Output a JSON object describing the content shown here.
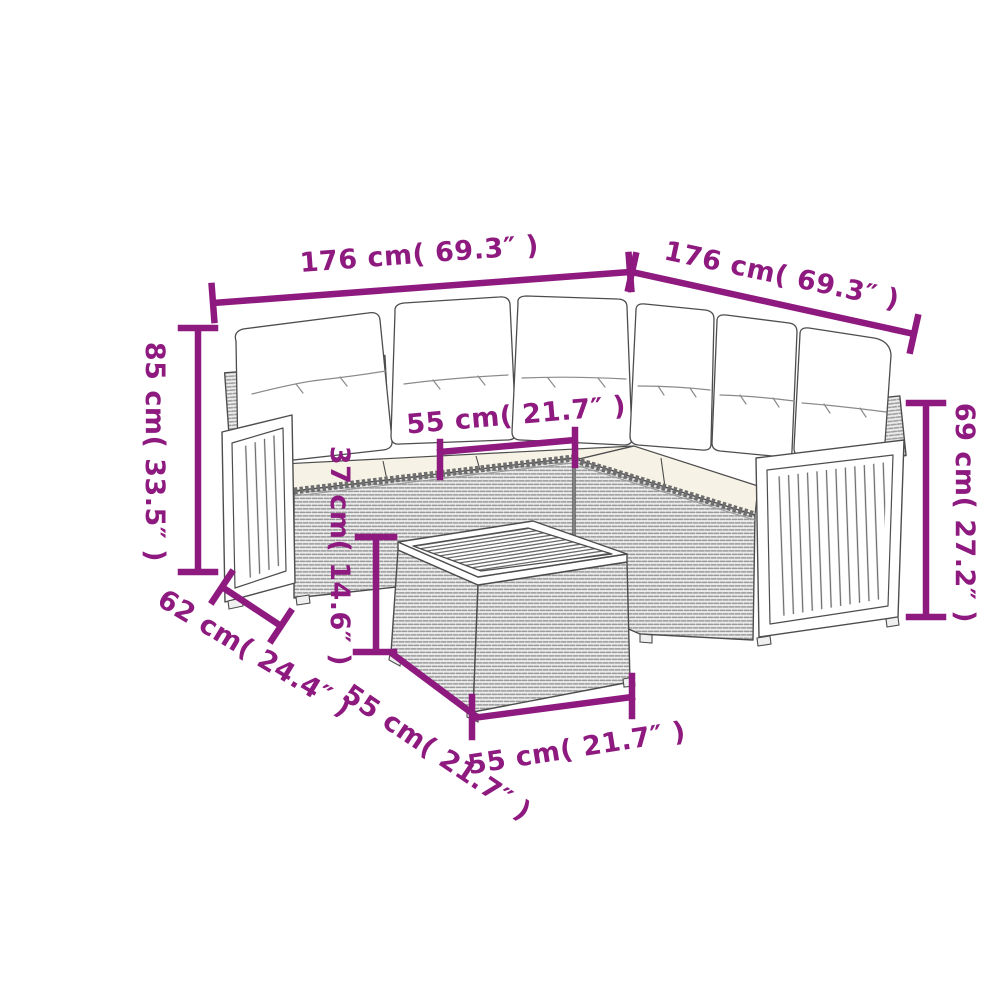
{
  "figure": {
    "type": "product-dimension-diagram",
    "subject": "corner rattan lounge set with slatted wood armrests, cushions and square side table",
    "background_color": "#ffffff",
    "accent_color": "#8e1a80",
    "line_art_color": "#4d4d4d"
  },
  "dimensions": {
    "sofa_left_width": {
      "label": "176 cm( 69.3″ )",
      "cm": 176,
      "inches": 69.3
    },
    "sofa_right_width": {
      "label": "176 cm( 69.3″ )",
      "cm": 176,
      "inches": 69.3
    },
    "sofa_height": {
      "label": "85 cm( 33.5″ )",
      "cm": 85,
      "inches": 33.5
    },
    "seat_width": {
      "label": "55 cm( 21.7″ )",
      "cm": 55,
      "inches": 21.7
    },
    "table_height": {
      "label": "37 cm( 14.6″ )",
      "cm": 37,
      "inches": 14.6
    },
    "right_side_height": {
      "label": "69 cm( 27.2″ )",
      "cm": 69,
      "inches": 27.2
    },
    "seat_depth": {
      "label": "62 cm( 24.4″ )",
      "cm": 62,
      "inches": 24.4
    },
    "table_depth": {
      "label": "55 cm( 21.7″ )",
      "cm": 55,
      "inches": 21.7
    },
    "table_width": {
      "label": "55 cm( 21.7″ )",
      "cm": 55,
      "inches": 21.7
    }
  }
}
